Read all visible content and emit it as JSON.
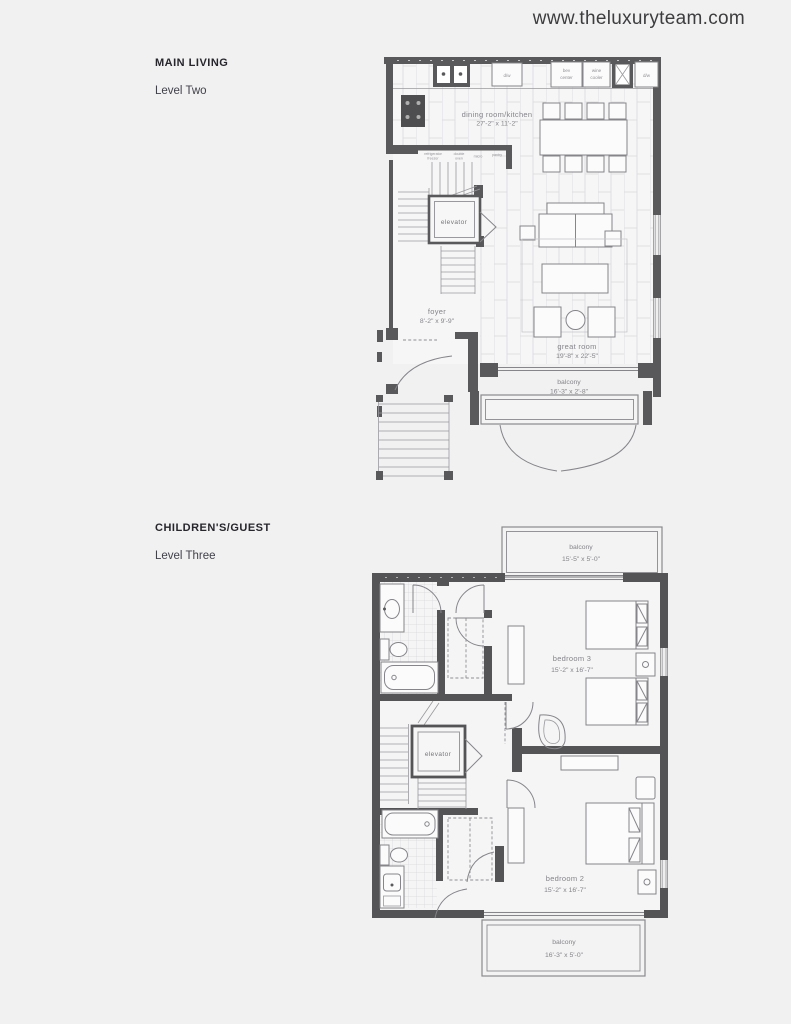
{
  "page": {
    "website": "www.theluxuryteam.com"
  },
  "sections": {
    "main_living": {
      "title": "MAIN LIVING",
      "level": "Level Two"
    },
    "childrens_guest": {
      "title": "CHILDREN'S/GUEST",
      "level": "Level Three"
    }
  },
  "level_two": {
    "dining_kitchen_name": "dining room/kitchen",
    "dining_kitchen_dims": "27'-2\" x 11'-2\"",
    "foyer_name": "foyer",
    "foyer_dims": "8'-2\" x 9'-9\"",
    "great_room_name": "great room",
    "great_room_dims": "19'-8\" x 22'-5\"",
    "balcony_name": "balcony",
    "balcony_dims": "16'-3\" x 2'-8\"",
    "elevator_label": "elevator",
    "dw1": "d/w",
    "bev_line1": "bev",
    "bev_line2": "center",
    "wine_line1": "wine",
    "wine_line2": "cooler",
    "dw2": "d/w",
    "refrigerator": "refrigerator",
    "freezer": "freezer",
    "double": "double",
    "oven": "oven",
    "micro": "micro",
    "pantry": "pantry"
  },
  "level_three": {
    "balcony_top_name": "balcony",
    "balcony_top_dims": "15'-5\" x 5'-0\"",
    "bedroom3_name": "bedroom 3",
    "bedroom3_dims": "15'-2\" x 16'-7\"",
    "elevator_label": "elevator",
    "bedroom2_name": "bedroom 2",
    "bedroom2_dims": "15'-2\" x 16'-7\"",
    "balcony_bottom_name": "balcony",
    "balcony_bottom_dims": "16'-3\" x 5'-0\""
  },
  "colors": {
    "wall": "#59595b",
    "wall_dark": "#545456",
    "line": "#85858a",
    "label": "#8a8a8e",
    "heading": "#26262c"
  }
}
